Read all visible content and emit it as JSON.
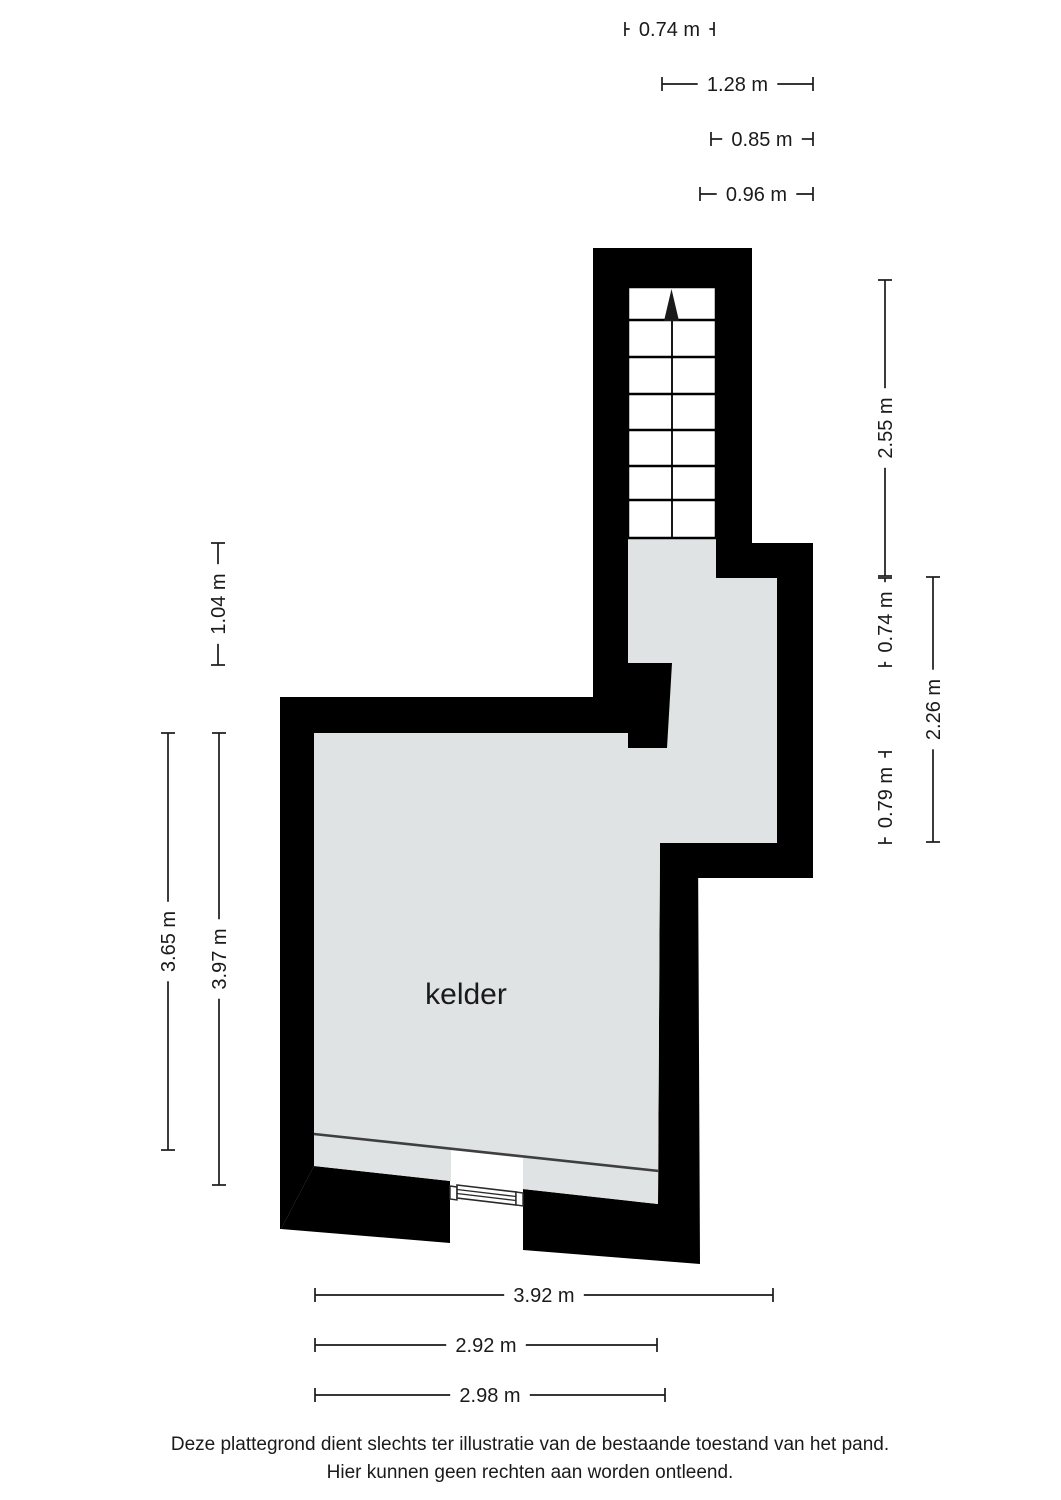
{
  "floorplan": {
    "room_label": "kelder",
    "colors": {
      "wall": "#000000",
      "floor": "#dfe3e4",
      "dim_line": "#1a1a1a",
      "detail_line": "#3f3f3f"
    }
  },
  "dimensions": [
    {
      "id": "dim-top-074",
      "label": "0.74 m",
      "orient": "h",
      "x1": 625,
      "x2": 714,
      "y": 29
    },
    {
      "id": "dim-top-128",
      "label": "1.28 m",
      "orient": "h",
      "x1": 662,
      "x2": 813,
      "y": 84
    },
    {
      "id": "dim-top-085",
      "label": "0.85 m",
      "orient": "h",
      "x1": 711,
      "x2": 813,
      "y": 139
    },
    {
      "id": "dim-top-096",
      "label": "0.96 m",
      "orient": "h",
      "x1": 700,
      "x2": 813,
      "y": 194
    },
    {
      "id": "dim-left-104",
      "label": "1.04 m",
      "orient": "v",
      "x": 218,
      "y1": 543,
      "y2": 665
    },
    {
      "id": "dim-left-365",
      "label": "3.65 m",
      "orient": "v",
      "x": 168,
      "y1": 733,
      "y2": 1150
    },
    {
      "id": "dim-left-397",
      "label": "3.97 m",
      "orient": "v",
      "x": 219,
      "y1": 733,
      "y2": 1185
    },
    {
      "id": "dim-right-255",
      "label": "2.55 m",
      "orient": "v",
      "x": 885,
      "y1": 280,
      "y2": 576
    },
    {
      "id": "dim-right-074",
      "label": "0.74 m",
      "orient": "v",
      "x": 885,
      "y1": 578,
      "y2": 666
    },
    {
      "id": "dim-right-079",
      "label": "0.79 m",
      "orient": "v",
      "x": 885,
      "y1": 752,
      "y2": 843
    },
    {
      "id": "dim-right-226",
      "label": "2.26 m",
      "orient": "v",
      "x": 933,
      "y1": 577,
      "y2": 842
    },
    {
      "id": "dim-bottom-392",
      "label": "3.92 m",
      "orient": "h",
      "x1": 315,
      "x2": 773,
      "y": 1295
    },
    {
      "id": "dim-bottom-292",
      "label": "2.92 m",
      "orient": "h",
      "x1": 315,
      "x2": 657,
      "y": 1345
    },
    {
      "id": "dim-bottom-298",
      "label": "2.98 m",
      "orient": "h",
      "x1": 315,
      "x2": 665,
      "y": 1395
    }
  ],
  "footer": {
    "line1": "Deze plattegrond dient slechts ter illustratie van de bestaande toestand van het pand.",
    "line2": "Hier kunnen geen rechten aan worden ontleend."
  }
}
